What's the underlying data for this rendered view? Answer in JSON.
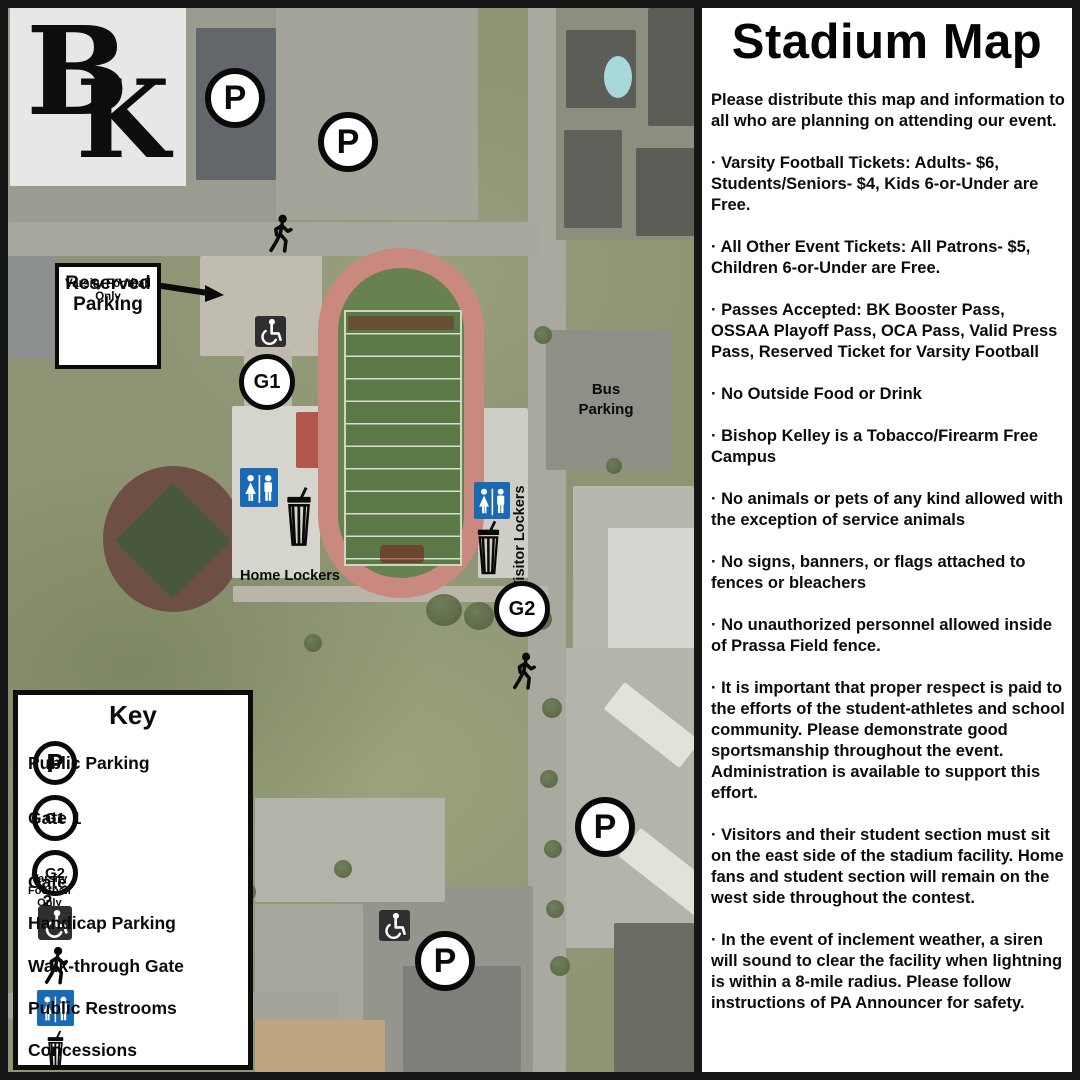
{
  "panel": {
    "title": "Stadium Map",
    "paragraphs": [
      "Please distribute this map and information to all who are planning on attending our event.",
      "· Varsity Football Tickets: Adults- $6, Students/Seniors- $4, Kids 6-or-Under are Free.",
      "· All Other Event Tickets: All Patrons- $5, Children 6-or-Under are Free.",
      "· Passes Accepted: BK Booster Pass, OSSAA Playoff Pass, OCA Pass, Valid Press Pass, Reserved Ticket for Varsity Football",
      "· No Outside Food or Drink",
      "· Bishop Kelley is a Tobacco/Firearm Free Campus",
      "· No animals or pets of any kind allowed with the exception of service animals",
      "· No signs, banners, or flags attached to fences or bleachers",
      "· No unauthorized personnel allowed inside of Prassa Field fence.",
      "· It is important that proper respect is paid to the efforts of the student-athletes and school community. Please demonstrate good sportsmanship throughout the event. Administration is available to support this effort.",
      "· Visitors and their student section must sit on the east side of the stadium facility. Home fans and student section will remain on the west side throughout the contest.",
      "· In the event of inclement weather, a siren will sound to clear the facility when lightning is within a 8-mile radius. Please follow instructions of PA Announcer for safety."
    ]
  },
  "map": {
    "logo": {
      "b": "B",
      "k": "K"
    },
    "markers": {
      "p": "P",
      "g1": "G1",
      "g2": "G2"
    },
    "reserved_sign": {
      "title": "Reserved Parking",
      "sub": "Varsity Football Only"
    },
    "labels": {
      "bus_parking": "Bus Parking",
      "home_lockers": "Home Lockers",
      "visitor_lockers": "Visitor Lockers"
    }
  },
  "key": {
    "title": "Key",
    "items": {
      "public_parking": {
        "symbol": "P",
        "label": "Public Parking"
      },
      "gate1": {
        "symbol": "G1",
        "label": "Gate 1"
      },
      "gate2": {
        "symbol": "G2",
        "label": "Gate 2",
        "sublabel": "Varsity Football Only"
      },
      "handicap": {
        "label": "Handicap Parking"
      },
      "walk_gate": {
        "label": "Walk-through Gate"
      },
      "restrooms": {
        "label": "Public Restrooms"
      },
      "concessions": {
        "label": "Concessions"
      }
    }
  },
  "colors": {
    "restroom_blue": "#1a69b4",
    "track_pink": "#ca897e",
    "field_green": "#5a7947",
    "handicap_dark": "#2f2f2f",
    "logo_bg": "#e7e7e5"
  }
}
